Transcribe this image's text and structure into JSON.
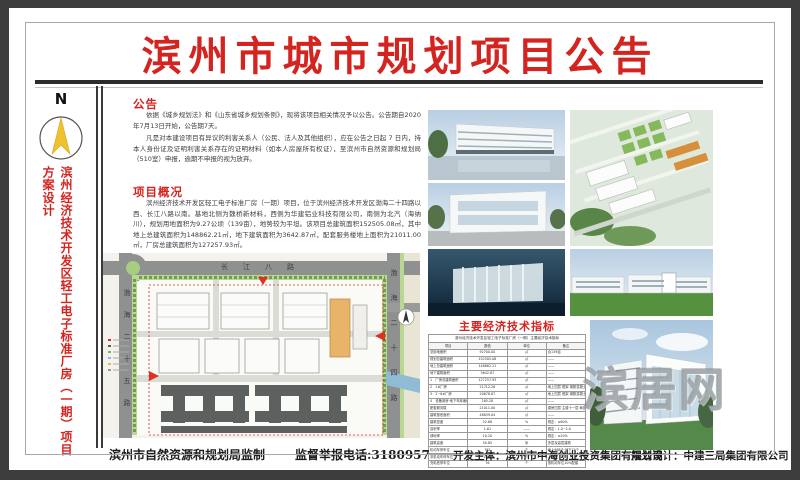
{
  "poster": {
    "title": "滨州市城市规划项目公告"
  },
  "sidebar": {
    "compass_label": "N",
    "vertical_title": "滨州经济技术开发区轻工电子标准厂房（一期）项目方案设计"
  },
  "announcement": {
    "heading": "公告",
    "para1": "依据《城乡规划法》和《山东省城乡规划条例》，现将该项目相关情况予以公告。公告期自2020年7月13日开始，公告期7天。",
    "para2": "凡是对本建设项目有异议的利害关系人（公民、法人及其他组织），应在公告之日起 7 日内，持本人身份证及证明利害关系存在的证明材料（如本人房屋所有权证），至滨州市自然资源和规划局（510室）申报，逾期不申报的视为放弃。"
  },
  "overview": {
    "heading": "项目概况",
    "para1": "滨州经济技术开发区轻工电子标准厂房（一期）项目，位于滨州经济技术开发区渤海二十四路以西、长江八路以南。基地北侧为魏桥新材料，西侧为华建铝业科技有限公司，南侧为北汽（海纳川），规划用地面积为9.27公顷（139亩），地势较为平坦。该项目总建筑面积152505.08㎡，其中地上总建筑面积为148862.21㎡，地下建筑面积为3642.87㎡，配套服务楼地上面积为21011.00㎡，厂房总建筑面积为127257.93㎡。"
  },
  "site_plan": {
    "road_top": "长江八路",
    "road_left": "渤海二十五路",
    "road_right": "渤海二十四路"
  },
  "indicators": {
    "heading": "主要经济技术指标",
    "table_title": "滨州经济技术开发区轻工电子标准厂房（一期）主要经济技术指标",
    "columns": [
      "项目",
      "数值",
      "单位",
      "备注"
    ],
    "rows": [
      [
        "总用地面积",
        "92700.00",
        "㎡",
        "合139亩"
      ],
      [
        "规划总建筑面积",
        "152505.08",
        "㎡",
        "——"
      ],
      [
        "地上总建筑面积",
        "148862.21",
        "㎡",
        "——"
      ],
      [
        "地下建筑面积",
        "3642.87",
        "㎡",
        "——"
      ],
      [
        "1　厂房总建筑面积",
        "127257.93",
        "㎡",
        "——"
      ],
      [
        "2　1#厂房",
        "21712.26",
        "㎡",
        "地上四层 框架 钢筋混凝土"
      ],
      [
        "3　2~6#厂房",
        "20678.87",
        "㎡",
        "地上四层 框架 钢筋混凝土"
      ],
      [
        "4　设备用房·地下车库面积",
        "165.28",
        "㎡",
        "——"
      ],
      [
        "配套服务楼",
        "21011.00",
        "㎡",
        "裙房四层·主楼十一层·局部地下一层"
      ],
      [
        "建筑基底面积",
        "48839.04",
        "㎡",
        "——"
      ],
      [
        "建筑密度",
        "52.68",
        "%",
        "规定：≤60%"
      ],
      [
        "容积率",
        "1.61",
        "——",
        "规定：1.0~2.0"
      ],
      [
        "绿地率",
        "10.20",
        "%",
        "规定：≤20%"
      ],
      [
        "建筑高度",
        "50.85",
        "米",
        "多层及高层建筑"
      ],
      [
        "机动车停车位",
        "762",
        "个",
        "地上688个·地下74个"
      ],
      [
        "非机动车停车位",
        "1500",
        "个",
        "——"
      ],
      [
        "充电桩停车位",
        "76",
        "个",
        "按机动车位10%配建"
      ]
    ]
  },
  "footer": {
    "producer": "滨州市自然资源和规划局监制",
    "hotline": "监督举报电话:3180957",
    "developer": "开发主体：滨州市中海创业投资集团有限公司",
    "designer": "规划设计：中建三局集团有限公司"
  },
  "watermark": {
    "text": "滨居网"
  },
  "colors": {
    "accent_red": "#d42420",
    "frame": "#3c3c3c",
    "map_green": "#b9d693",
    "map_orange": "#e8b469"
  }
}
